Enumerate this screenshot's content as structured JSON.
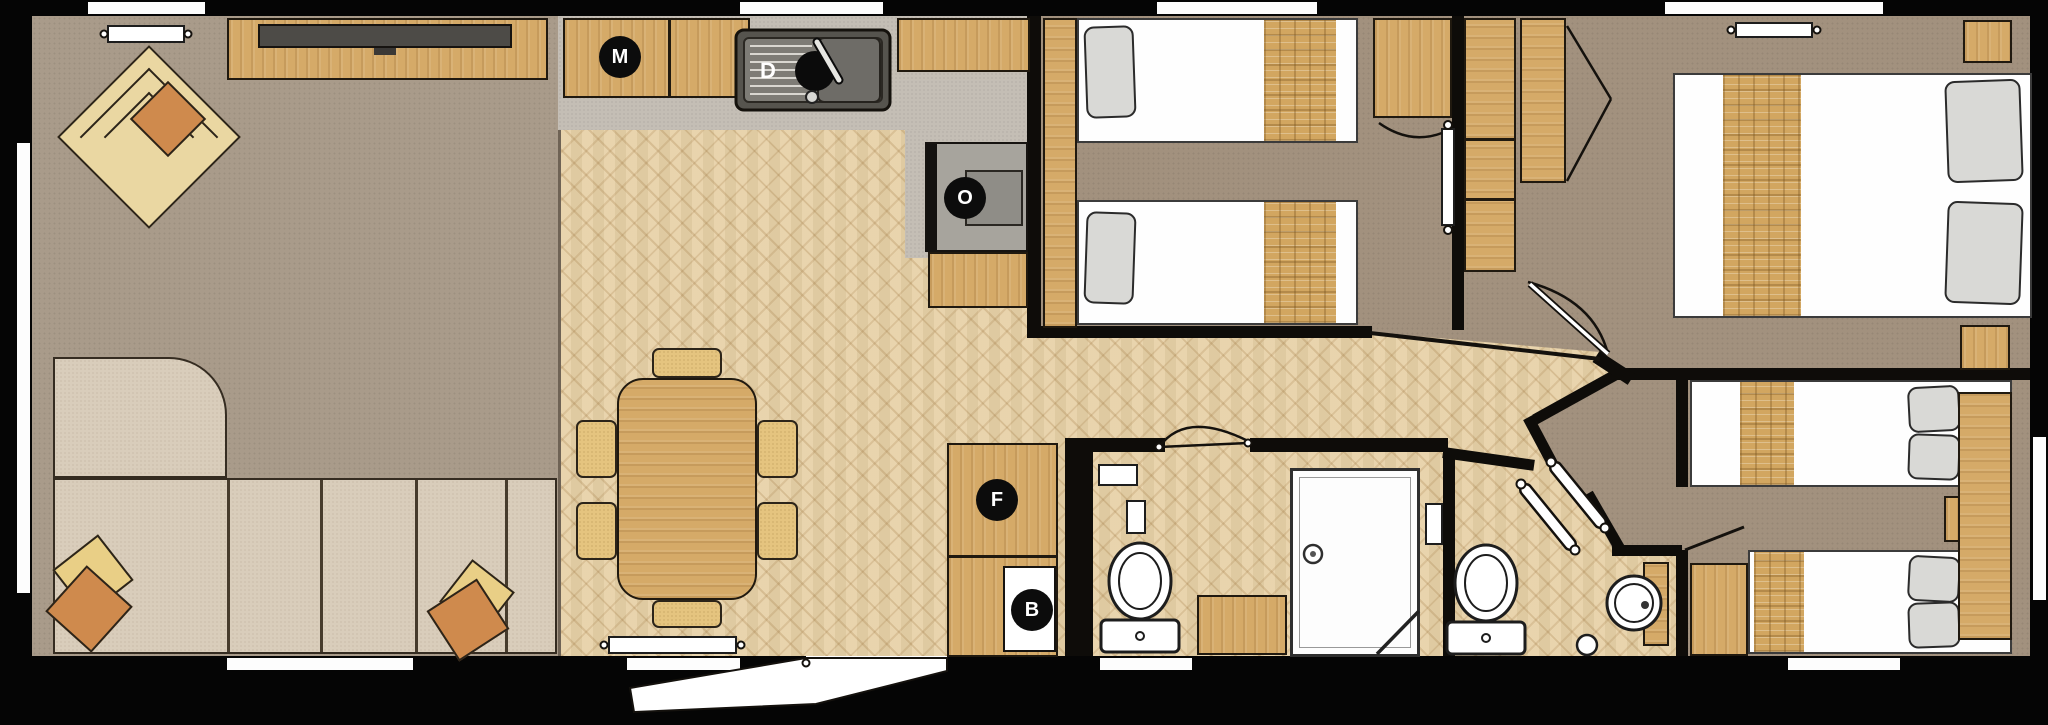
{
  "floorplan": {
    "appliances": {
      "microwave": {
        "label": "M"
      },
      "dishwasher": {
        "label": "D"
      },
      "oven": {
        "label": "O"
      },
      "fridge": {
        "label": "F"
      },
      "boiler": {
        "label": "B"
      }
    },
    "colors": {
      "wall": "#0e0c09",
      "carpet_living": "#a99b8a",
      "carpet_bedroom": "#a2917e",
      "wood_floor": "#e7d1a7",
      "counter_grey": "#c4beb5",
      "wood_furniture": "#d5aa68",
      "sofa": "#d9cdbb",
      "cushion_orange": "#cf8a4d",
      "cushion_yellow": "#e9cf86",
      "appliance_disc": "#0c0c0c"
    }
  }
}
